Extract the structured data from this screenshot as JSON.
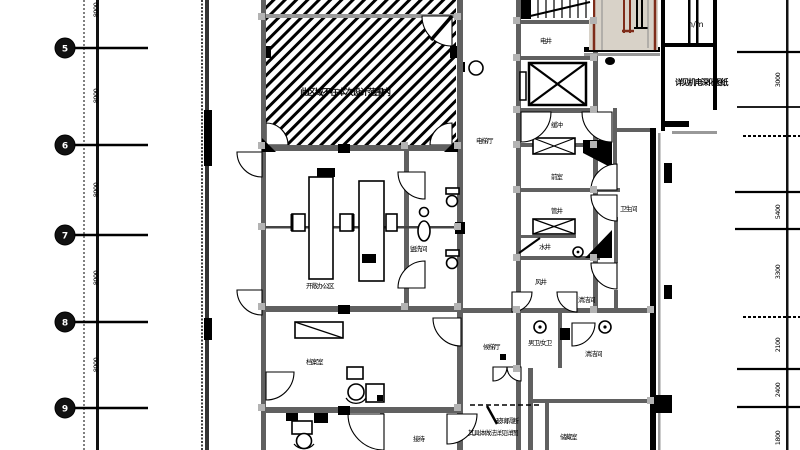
{
  "colors": {
    "wall": "#606060",
    "escalator_fill": "#d8d2c8",
    "escalator_line": "#7e2c1a"
  },
  "labels": {
    "hatch_room": "此区域不在本次设计范围内",
    "office": "开敞办公区",
    "washroom": "盥洗间",
    "archive": "档案室",
    "buffer": "缓冲",
    "shaft_top": "电井",
    "anteroom": "前室",
    "shaft_a": "管井",
    "shaft_b": "水井",
    "shaft_c": "风井",
    "wc_corridor": "卫生间",
    "wash2": "清洁间",
    "lobby": "电梯厅",
    "lobby2": "候梯厅",
    "wc_mf": "男卫/女卫",
    "storage": "储藏室",
    "reception": "接待",
    "level_mark": "n/m",
    "equip_note": "详见机电深化图纸",
    "note1": "玻璃隔断",
    "note2": "其具体做法详见详图"
  },
  "grid": {
    "left_bubbles": [
      "5",
      "6",
      "7",
      "8",
      "9"
    ],
    "left_dims": [
      "8000",
      "8000",
      "8000",
      "8000",
      "8000"
    ],
    "right_dims": [
      "3000",
      "5400",
      "3300",
      "2100",
      "2400",
      "1800"
    ]
  }
}
